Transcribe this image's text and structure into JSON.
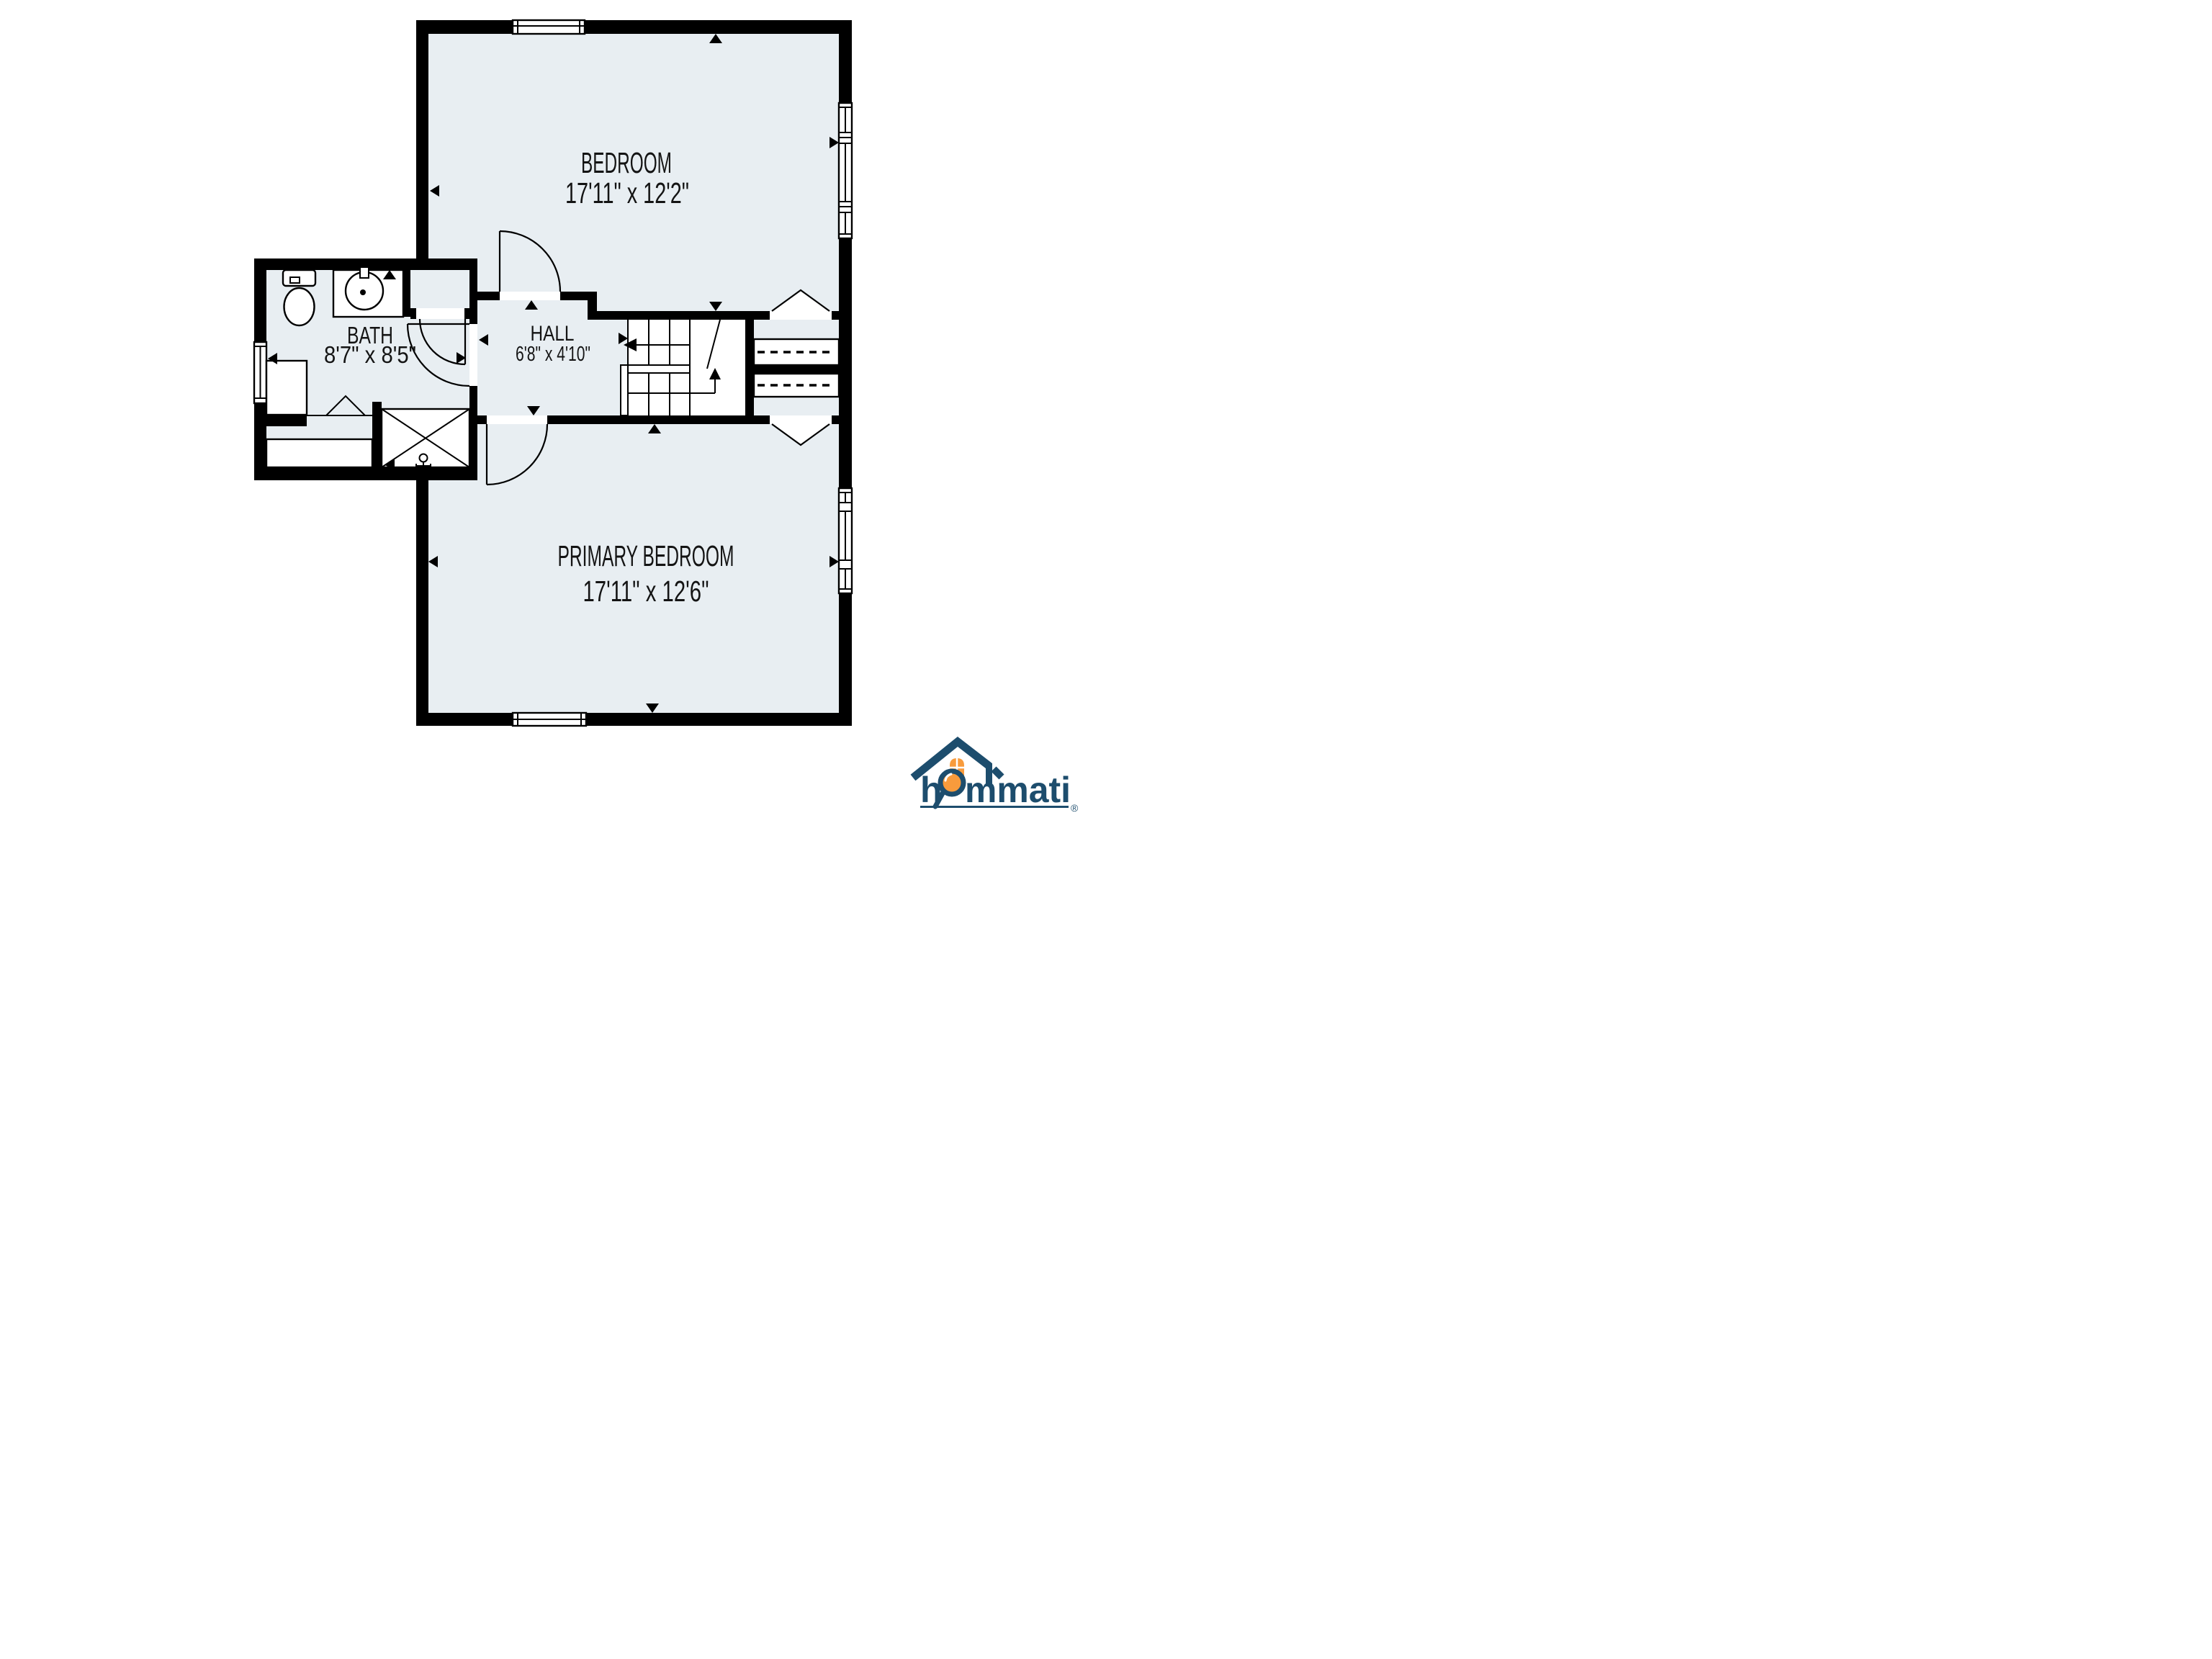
{
  "page": {
    "background": "#ffffff"
  },
  "floor_plan": {
    "type": "residential-floor-plan",
    "colors": {
      "floor": "#e8eef2",
      "wall": "#000000",
      "line": "#000000",
      "label": "#141414"
    },
    "rooms": [
      {
        "id": "bedroom",
        "name": "BEDROOM",
        "dimensions": "17'11\" x 12'2\""
      },
      {
        "id": "bath",
        "name": "BATH",
        "dimensions": "8'7\" x 8'5\""
      },
      {
        "id": "hall",
        "name": "HALL",
        "dimensions": "6'8\" x 4'10\""
      },
      {
        "id": "primary_bedroom",
        "name": "PRIMARY BEDROOM",
        "dimensions": "17'11\" x 12'6\""
      }
    ],
    "features": [
      "stairs",
      "closets-with-hanging-rods",
      "toilet",
      "vanity-sink",
      "shower",
      "laundry-counter",
      "windows",
      "door-swings"
    ]
  },
  "logo": {
    "brand": "hommati",
    "brand_prefix": "h",
    "brand_suffix": "mmati",
    "registered": "®",
    "navy": "#1d4d6d",
    "orange": "#f89b3c"
  }
}
